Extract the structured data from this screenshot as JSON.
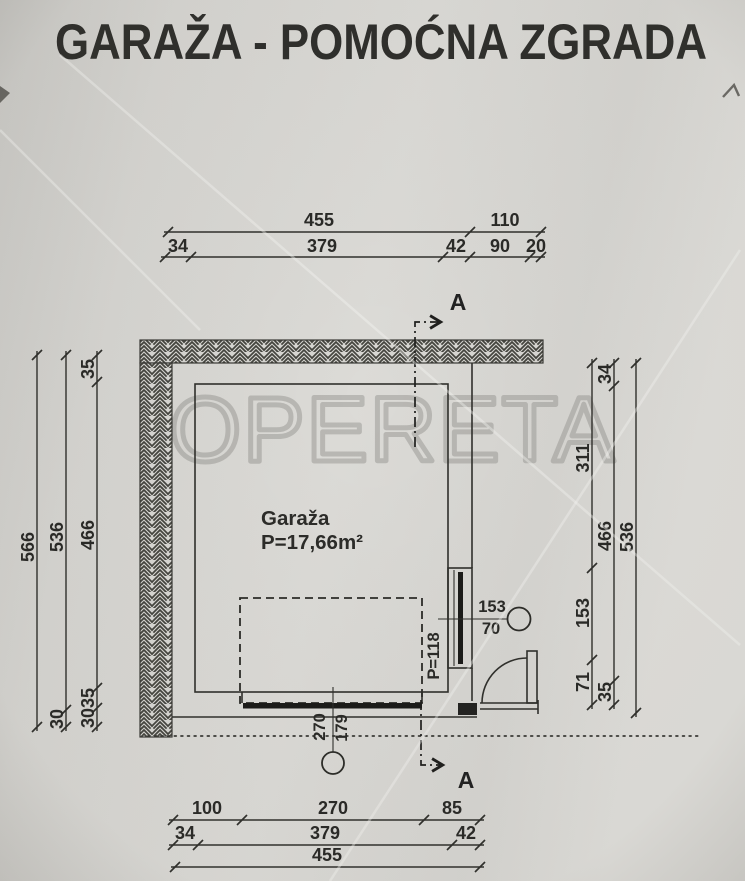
{
  "title": "GARAŽA - POMOĆNA ZGRADA",
  "watermark": "OPERETA",
  "section_marker": {
    "label": "A"
  },
  "room": {
    "name": "Garaža",
    "area": "P=17,66m²"
  },
  "window": {
    "width": "153",
    "sill_height": "70",
    "label": "P=118"
  },
  "garage_door": {
    "width": "270",
    "height": "179"
  },
  "dims": {
    "top": {
      "total": "455",
      "ext": "110",
      "a": "34",
      "b": "379",
      "c": "42",
      "d": "90",
      "e": "20"
    },
    "bottom": {
      "a": "100",
      "b": "270",
      "c": "85",
      "d": "34",
      "e": "379",
      "f": "42",
      "total": "455"
    },
    "left": {
      "total": "566",
      "a": "536",
      "b": "30",
      "c": "35",
      "d": "466",
      "e": "35",
      "f": "30"
    },
    "right": {
      "a": "311",
      "b": "153",
      "c": "71",
      "d": "34",
      "e": "466",
      "f": "35",
      "total": "536"
    }
  }
}
